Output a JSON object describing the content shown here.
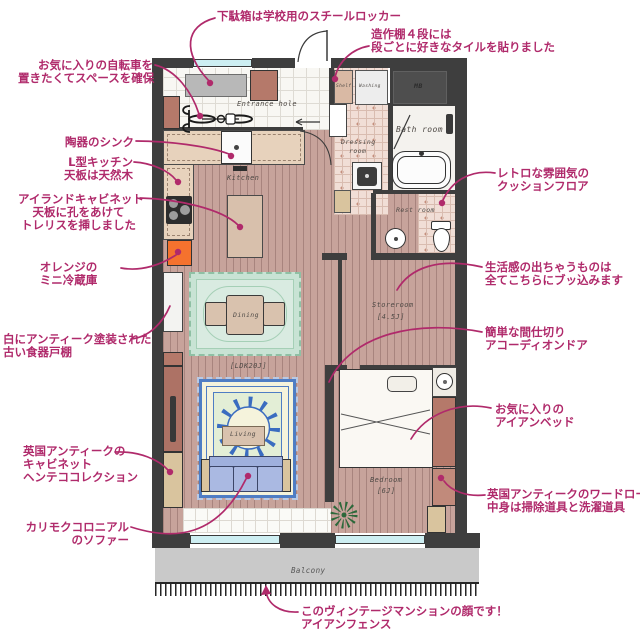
{
  "rooms": {
    "entrance": "Entrance hole",
    "kitchen": "Kitchen",
    "dining": "Dining",
    "living": "Living",
    "ldk_size": "[LDK20J]",
    "storeroom": "Storeroom",
    "storeroom_size": "[4.5J]",
    "bedroom": "Bedroom",
    "bedroom_size": "[6J]",
    "bath": "Bath room",
    "dressing_line1": "Dressing",
    "dressing_line2": "room",
    "rest": "Rest room",
    "shelf": "Shelf",
    "washing": "Washing",
    "mb": "MB",
    "balcony": "Balcony"
  },
  "annotations": [
    {
      "id": "shoe-locker",
      "lines": [
        "下駄箱は学校用のスチールロッカー"
      ]
    },
    {
      "id": "tile-shelf",
      "lines": [
        "造作棚４段には",
        "段ごとに好きなタイルを貼りました"
      ]
    },
    {
      "id": "bicycle-space",
      "lines": [
        "お気に入りの自転車を",
        "置きたくてスペースを確保"
      ]
    },
    {
      "id": "ceramic-sink",
      "lines": [
        "陶器のシンク"
      ]
    },
    {
      "id": "l-kitchen",
      "lines": [
        "L型キッチン",
        "天板は天然木"
      ]
    },
    {
      "id": "island-cabinet",
      "lines": [
        "アイランドキャビネット",
        "天板に孔をあけて",
        "トレリスを挿しました"
      ]
    },
    {
      "id": "mini-fridge",
      "lines": [
        "オレンジの",
        "ミニ冷蔵庫"
      ]
    },
    {
      "id": "old-cupboard",
      "lines": [
        "白にアンティーク塗装された",
        "古い食器戸棚"
      ]
    },
    {
      "id": "uk-cabinet",
      "lines": [
        "英国アンティークの",
        "キャビネット",
        "ヘンテココレクション"
      ]
    },
    {
      "id": "karimoku-sofa",
      "lines": [
        "カリモクコロニアル",
        "のソファー"
      ]
    },
    {
      "id": "cushion-floor",
      "lines": [
        "レトロな雰囲気の",
        "クッションフロア"
      ]
    },
    {
      "id": "storeroom-stuff",
      "lines": [
        "生活感の出ちゃうものは",
        "全てこちらにブッ込みます"
      ]
    },
    {
      "id": "accordion-door",
      "lines": [
        "簡単な間仕切り",
        "アコーディオンドア"
      ]
    },
    {
      "id": "iron-bed",
      "lines": [
        "お気に入りの",
        "アイアンベッド"
      ]
    },
    {
      "id": "uk-wardrobe",
      "lines": [
        "英国アンティークのワードローブ",
        "中身は掃除道具と洗濯道具"
      ]
    },
    {
      "id": "iron-fence",
      "lines": [
        "このヴィンテージマンションの顔です！",
        "アイアンフェンス"
      ]
    }
  ],
  "colors": {
    "accent": "#b02a6b",
    "wall": "#3e3e3e",
    "wood_floor": "#c7a39b",
    "balcony": "#c9c9c9",
    "window": "#cdeef2",
    "dining_rug": "#c8e3d4",
    "living_rug_border": "#4f7dc4",
    "sofa": "#aab9e2",
    "fridge": "#f5722e",
    "furniture_brown": "#b5796a",
    "furniture_tan": "#d9c49e"
  }
}
